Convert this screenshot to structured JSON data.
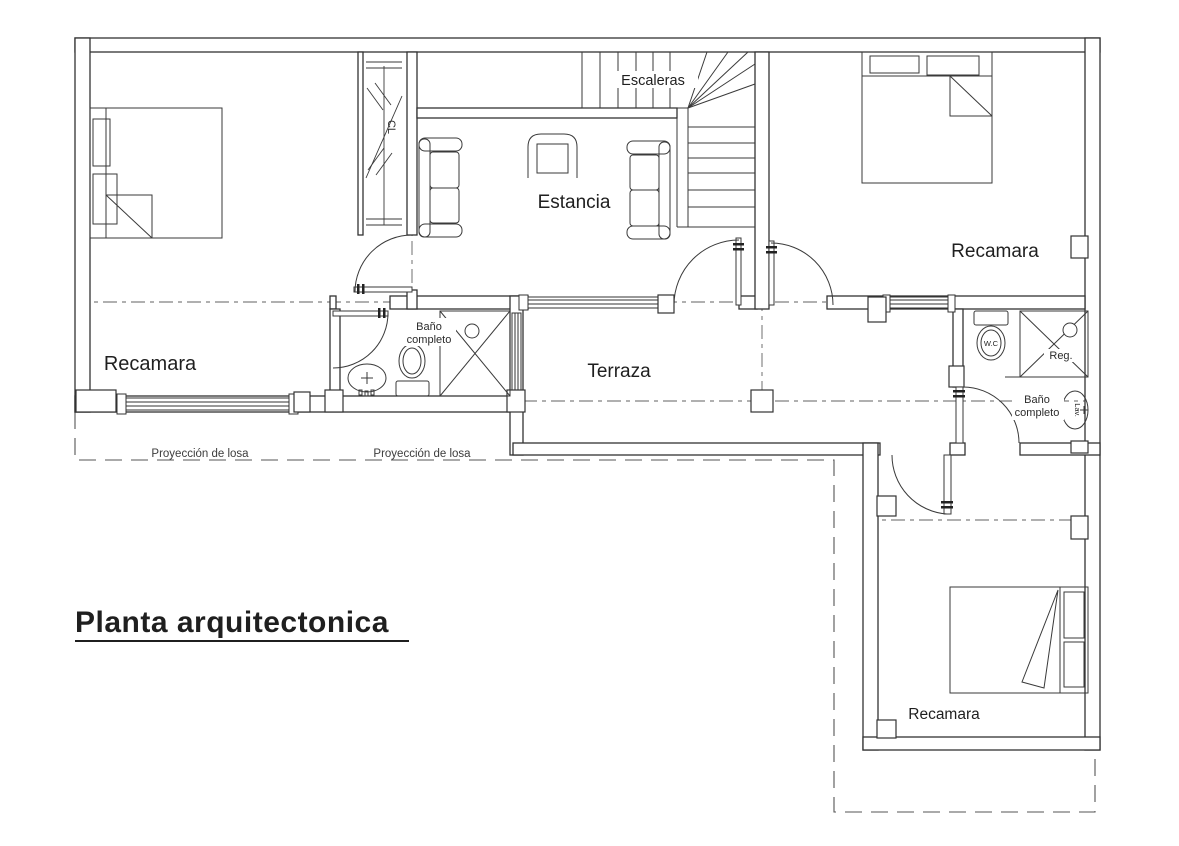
{
  "title": "Planta arquitectonica",
  "rooms": {
    "bedroom_left": "Recamara",
    "bedroom_right": "Recamara",
    "bedroom_lower": "Recamara",
    "living_room": "Estancia",
    "terrace": "Terraza",
    "stairs": "Escaleras",
    "closet": "CL",
    "bath_left_line1": "Baño",
    "bath_left_line2": "completo",
    "bath_right_line1": "Baño",
    "bath_right_line2": "completo"
  },
  "fixtures": {
    "toilet": "W.C",
    "shower": "Reg.",
    "sink": "Lav."
  },
  "annotations": {
    "slab_projection_1": "Proyección de losa",
    "slab_projection_2": "Proyección de losa"
  },
  "colors": {
    "background": "#ffffff",
    "line": "#3a3a3a",
    "wall": "#333333",
    "axis": "#606060",
    "text": "#1f1f1f"
  }
}
